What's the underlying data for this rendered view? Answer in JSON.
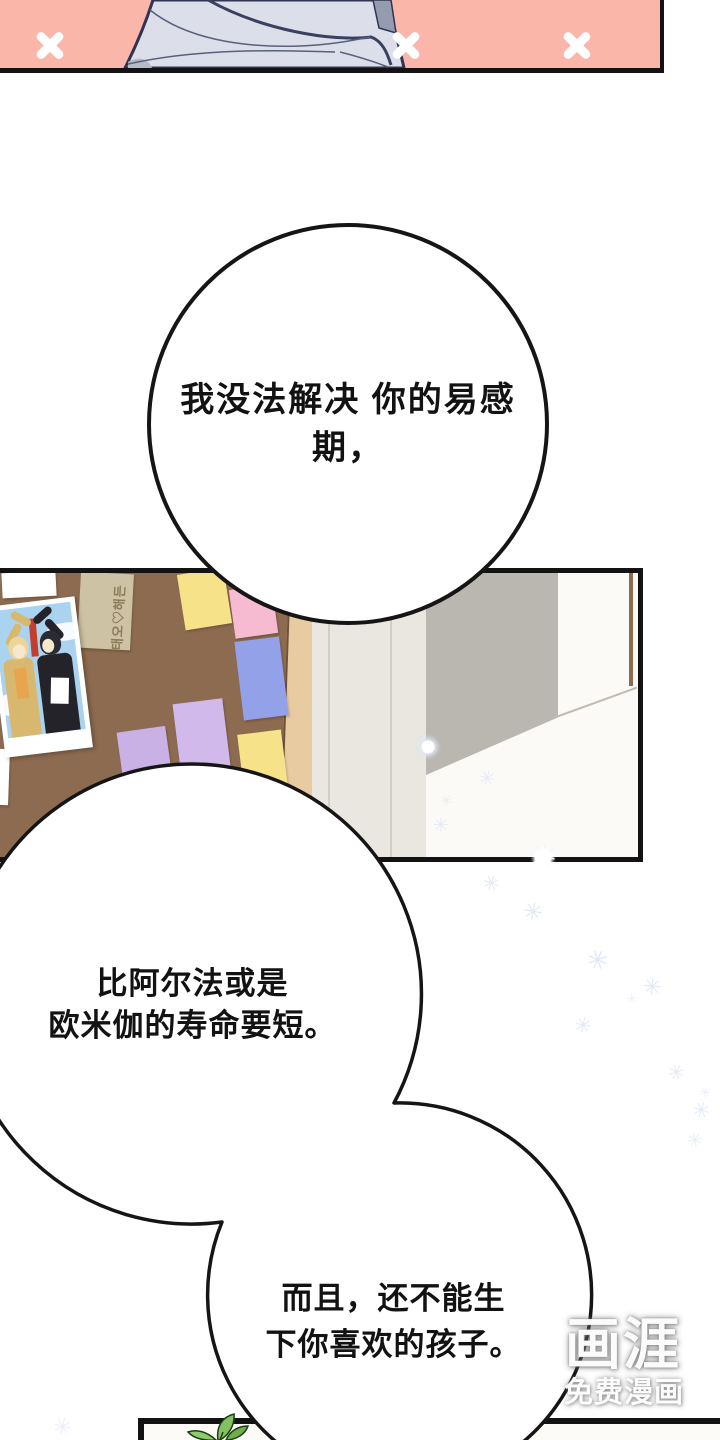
{
  "page": {
    "width": 720,
    "height": 1440,
    "type": "webtoon-comic-page"
  },
  "bubbles": [
    {
      "id": "bubble-1",
      "lines": [
        "我没法解决",
        "你的易感期，"
      ]
    },
    {
      "id": "bubble-2",
      "lines": [
        "比阿尔法或是",
        "欧米伽的寿命要短。"
      ]
    },
    {
      "id": "bubble-3",
      "lines": [
        "而且，还不能生",
        "下你喜欢的孩子。"
      ]
    }
  ],
  "corkboard": {
    "photo_note_text": "태오♡해든"
  },
  "watermark": {
    "logo": "画涯",
    "caption": "免费漫画"
  },
  "colors": {
    "panel_top_bg": "#f9b6a9",
    "panel_border": "#131313",
    "corkboard_brown": "#8d6b50",
    "board_frame": "#e8cba0",
    "wall_cream": "#eae7e1",
    "wall_shadow_gray": "#bab7b1",
    "note_yellow": "#f5e289",
    "note_pink": "#f7bbd1",
    "note_periwinkle": "#93a2e8",
    "note_lavender": "#d2b9ec",
    "note_purple": "#c9b0e5",
    "note_tan": "#cdc2a3",
    "garment_fabric": "#dcdfe9",
    "sparkle_blue": "#cfdaf0",
    "leaf_green": "#82c161",
    "photo_sky": "#a9d3ef"
  }
}
